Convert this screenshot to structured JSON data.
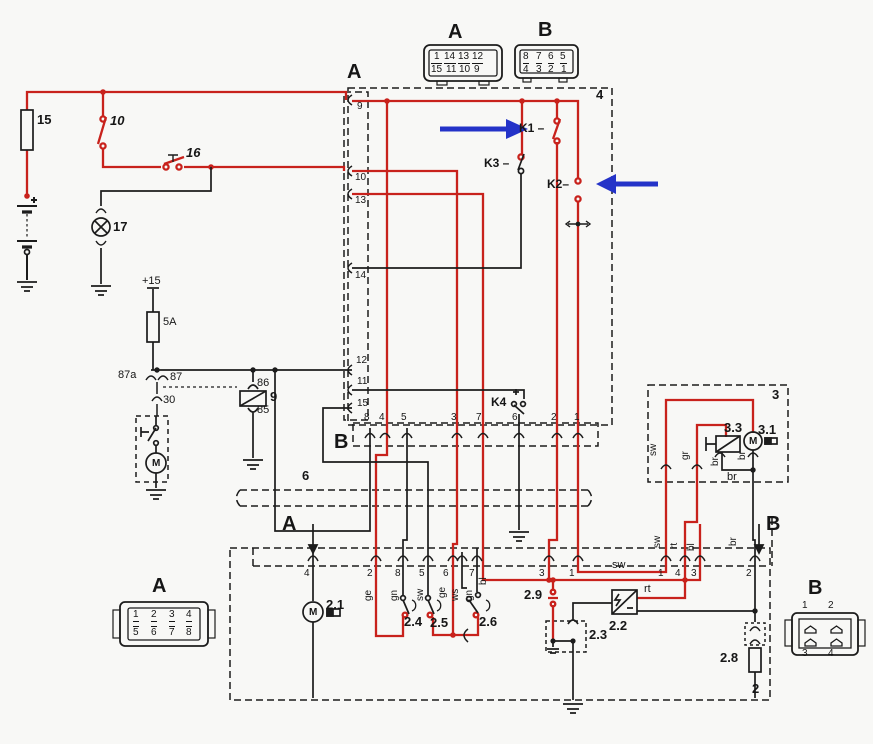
{
  "diagram": {
    "top_connector_a": {
      "title": "A",
      "pins_row1": [
        "1",
        "14",
        "13",
        "12"
      ],
      "pins_row2": [
        "15",
        "11",
        "10",
        "9"
      ]
    },
    "top_connector_b": {
      "title": "B",
      "pins_row1": [
        "8",
        "7",
        "6",
        "5"
      ],
      "pins_row2": [
        "4",
        "3",
        "2",
        "1"
      ]
    },
    "control_unit": {
      "box_label": "4",
      "connector_a_label": "A",
      "connector_b_label": "B",
      "pins_a": [
        "9",
        "10",
        "13",
        "14",
        "12",
        "11",
        "15"
      ],
      "pins_b": [
        "8",
        "4",
        "5",
        "3",
        "7",
        "6",
        "2",
        "1"
      ],
      "k1": "K1 –",
      "k2": "K2–",
      "k3": "K3 –",
      "k4": "K4"
    },
    "battery_branch": {
      "fuse": "15",
      "switch10": "10",
      "switch16": "16",
      "lamp": "17"
    },
    "ignition_branch": {
      "terminal": "+15",
      "fuse": "5A",
      "relay": "9",
      "t87a": "87a",
      "t87": "87",
      "t30": "30",
      "t86": "86",
      "t85": "85"
    },
    "band6_label": "6",
    "box3": {
      "label": "3",
      "valve": "3.3",
      "motor": "3.1",
      "w_sw": "sw",
      "w_gr": "gr",
      "w_br_left": "br",
      "w_br_right": "br",
      "w_br_bottom": "br"
    },
    "box2": {
      "label": "2",
      "motor21": "2.1",
      "comp22": "2.2",
      "comp23": "2.3",
      "sw24": "2.4",
      "sw25": "2.5",
      "sw26": "2.6",
      "fuse28": "2.8",
      "comp29": "2.9"
    },
    "lower_row": {
      "pins_left": [
        "4",
        "2",
        "8",
        "5",
        "6",
        "7"
      ],
      "pins_right": [
        "3",
        "1",
        "1",
        "4",
        "3",
        "2"
      ],
      "colors_left": [
        "ge",
        "gn",
        "sw",
        "ge",
        "ws",
        "gn",
        "bl"
      ],
      "colors_right": [
        "sw",
        "rt",
        "bl",
        "br"
      ],
      "link_sw": "sw",
      "link_rt": "rt"
    },
    "markers": {
      "a_down": "A",
      "b_down": "B"
    },
    "bottom_connector_a": {
      "title": "A",
      "pins_row1": [
        "1",
        "2",
        "3",
        "4"
      ],
      "pins_row2": [
        "5",
        "6",
        "7",
        "8"
      ]
    },
    "bottom_connector_b": {
      "title": "B",
      "pins_row1": [
        "1",
        "2"
      ],
      "pins_row2": [
        "3",
        "4"
      ]
    },
    "motor_letter": "M"
  },
  "colors": {
    "wire_red": "#c8221c",
    "wire_black": "#1c1c1c",
    "arrow_blue": "#2433c8"
  }
}
